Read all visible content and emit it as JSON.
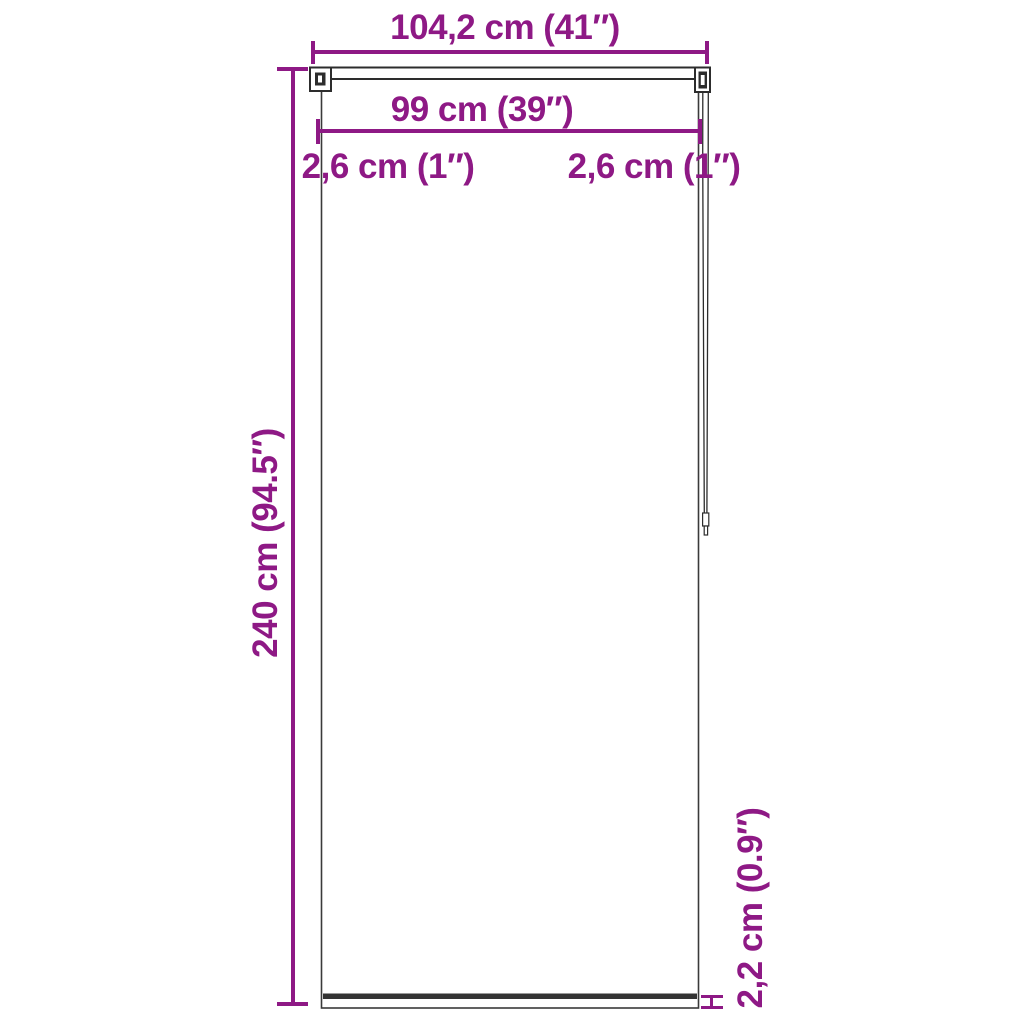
{
  "diagram": {
    "type": "product-dimension-diagram",
    "subject": "roller-blind-front-view"
  },
  "colors": {
    "dimension": "#8E1985",
    "outline": "#2D2D2D",
    "background": "#FFFFFF"
  },
  "dimensions": {
    "total_width": "104,2 cm (41″)",
    "fabric_width": "99 cm (39″)",
    "left_offset": "2,6 cm (1″)",
    "right_offset": "2,6 cm (1″)",
    "total_height": "240 cm (94.5″)",
    "bottom_bar_height": "2,2 cm (0.9″)"
  }
}
